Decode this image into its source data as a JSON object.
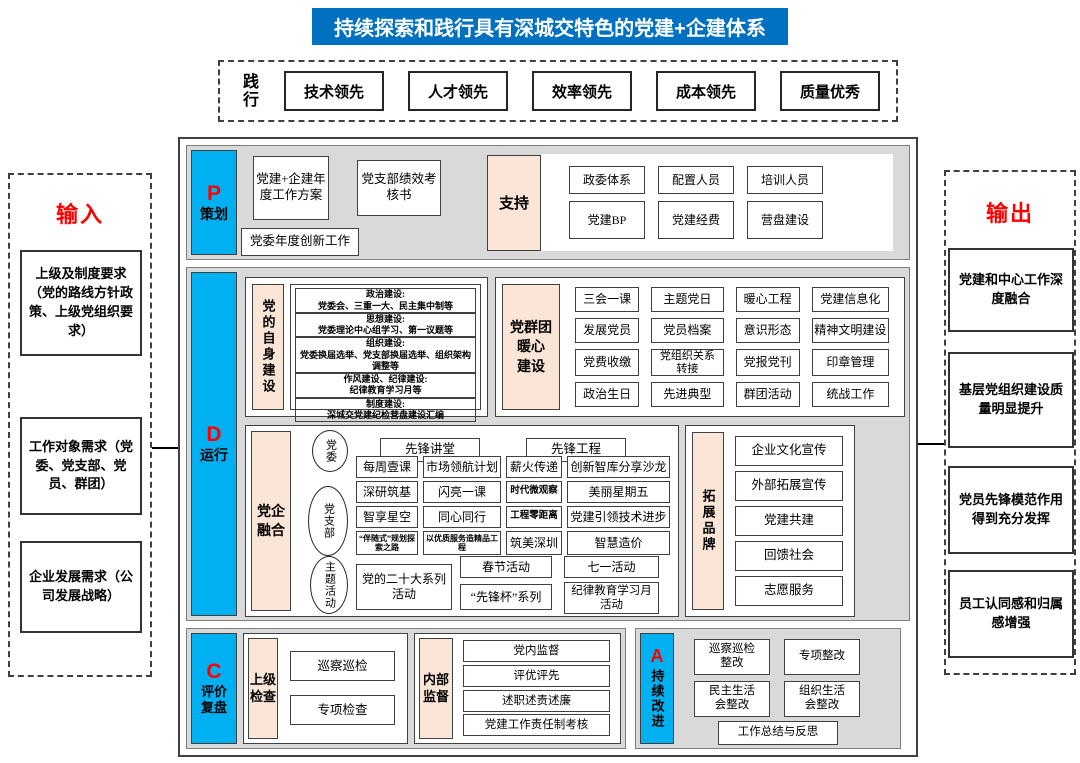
{
  "banner": {
    "title": "持续探索和践行具有深城交特色的党建+企建体系"
  },
  "practice": {
    "label": "践行",
    "items": [
      "技术领先",
      "人才领先",
      "效率领先",
      "成本领先",
      "质量优秀"
    ]
  },
  "input_panel": {
    "title": "输入",
    "items": [
      "上级及制度要求（党的路线方针政策、上级党组织要求）",
      "工作对象需求（党委、党支部、党员、群团）",
      "企业发展需求（公司发展战略）"
    ]
  },
  "output_panel": {
    "title": "输出",
    "items": [
      "党建和中心工作深度融合",
      "基层党组织建设质量明显提升",
      "党员先锋模范作用得到充分发挥",
      "员工认同感和归属感增强"
    ]
  },
  "p_section": {
    "letter": "P",
    "name": "策划",
    "plan_boxes": [
      "党建+企建年度工作方案",
      "党支部绩效考核书",
      "党委年度创新工作"
    ],
    "support": {
      "label": "支持",
      "items": [
        "政委体系",
        "配置人员",
        "培训人员",
        "党建BP",
        "党建经费",
        "营盘建设"
      ]
    }
  },
  "d_section": {
    "letter": "D",
    "name": "运行",
    "self_building": {
      "label": "党的自身建设",
      "items": [
        "政治建设:\n党委会、三重一大、民主集中制等",
        "思想建设:\n党委理论中心组学习、第一议题等",
        "组织建设:\n党委换届选举、党支部换届选举、组织架构调整等",
        "作风建设、纪律建设:\n纪律教育学习月等",
        "制度建设:\n深城交党建纪检营盘建设汇编"
      ]
    },
    "warm": {
      "label": "党群团\n暖心\n建设",
      "items": [
        "三会一课",
        "主题党日",
        "暖心工程",
        "党建信息化",
        "发展党员",
        "党员档案",
        "意识形态",
        "精神文明建设",
        "党费收缴",
        "党组织关系\n转接",
        "党报党刊",
        "印章管理",
        "政治生日",
        "先进典型",
        "群团活动",
        "统战工作"
      ]
    },
    "fusion": {
      "label": "党企\n融合",
      "committee": {
        "circle": "党委",
        "items": [
          "先锋讲堂",
          "先锋工程"
        ]
      },
      "branch": {
        "circle": "党支部",
        "rows": [
          [
            "每周壹课",
            "市场领航计划",
            "薪火传递",
            "创新智库分享沙龙"
          ],
          [
            "深研筑基",
            "闪亮一课",
            "时代微观察",
            "美丽星期五"
          ],
          [
            "智享星空",
            "同心同行",
            "工程零距离",
            "党建引领技术进步"
          ],
          [
            "“伴随式”规划探索之路",
            "以优质服务造精品工程",
            "筑美深圳",
            "智慧造价"
          ]
        ]
      },
      "theme": {
        "circle": "主题活动",
        "big_item": "党的二十大系列活动",
        "items": [
          "春节活动",
          "“先锋杯”系列",
          "七一活动",
          "纪律教育学习月\n活动"
        ]
      }
    },
    "brand": {
      "label": "拓展品牌",
      "items": [
        "企业文化宣传",
        "外部拓展宣传",
        "党建共建",
        "回馈社会",
        "志愿服务"
      ]
    }
  },
  "c_section": {
    "letter": "C",
    "name": "评价\n复盘",
    "upper_check": {
      "label": "上级\n检查",
      "items": [
        "巡察巡检",
        "专项检查"
      ]
    },
    "internal": {
      "label": "内部\n监督",
      "items": [
        "党内监督",
        "评优评先",
        "述职述责述廉",
        "党建工作责任制考核"
      ]
    }
  },
  "a_section": {
    "letter": "A",
    "name": "持续改进",
    "items": [
      "巡察巡检\n整改",
      "专项整改",
      "民主生活\n会整改",
      "组织生活\n会整改",
      "工作总结与反思"
    ]
  },
  "colors": {
    "banner_bg": "#0070C0",
    "phase_bg": "#00B0F0",
    "tag_bg": "#FBE5D6",
    "row_bg": "#D9D9D9",
    "accent_red": "#FF0000"
  }
}
